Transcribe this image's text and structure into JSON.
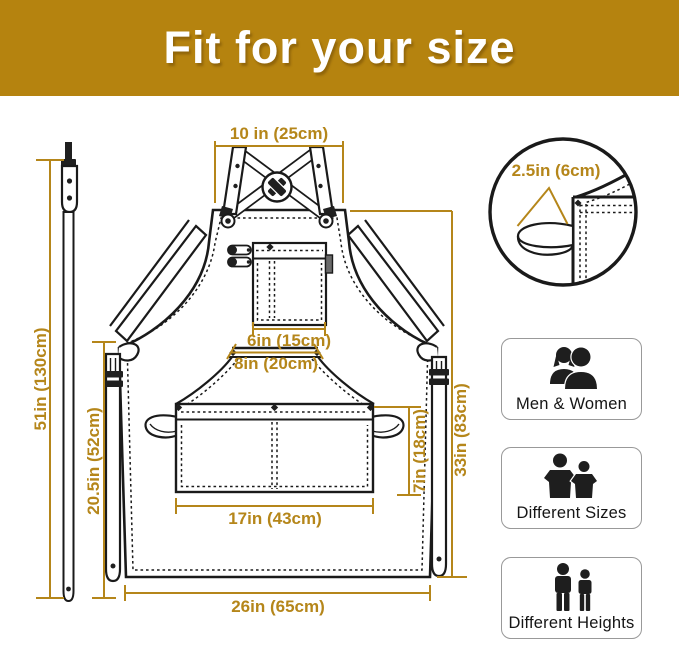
{
  "header": {
    "title": "Fit for your size"
  },
  "colors": {
    "accent": "#b5861a",
    "ink": "#1a1a1a",
    "header_bg": "#b5830f"
  },
  "diagram": {
    "description": "apron-size-diagram",
    "dimensions": {
      "top_width": "10 in (25cm)",
      "strap_width": "2.5in (6cm)",
      "chest_pocket_width": "6in (15cm)",
      "waist_pocket_width": "8in (20cm)",
      "neck_strap_length": "51in (130cm)",
      "side_length": "20.5in (52cm)",
      "front_pocket_height": "7in (18cm)",
      "front_pocket_width": "17in (43cm)",
      "body_length": "33in (83cm)",
      "bottom_width": "26in (65cm)"
    }
  },
  "features": [
    {
      "label": "Men & Women",
      "icon": "men-women-icon"
    },
    {
      "label": "Different Sizes",
      "icon": "different-sizes-icon"
    },
    {
      "label": "Different Heights",
      "icon": "different-heights-icon"
    }
  ]
}
